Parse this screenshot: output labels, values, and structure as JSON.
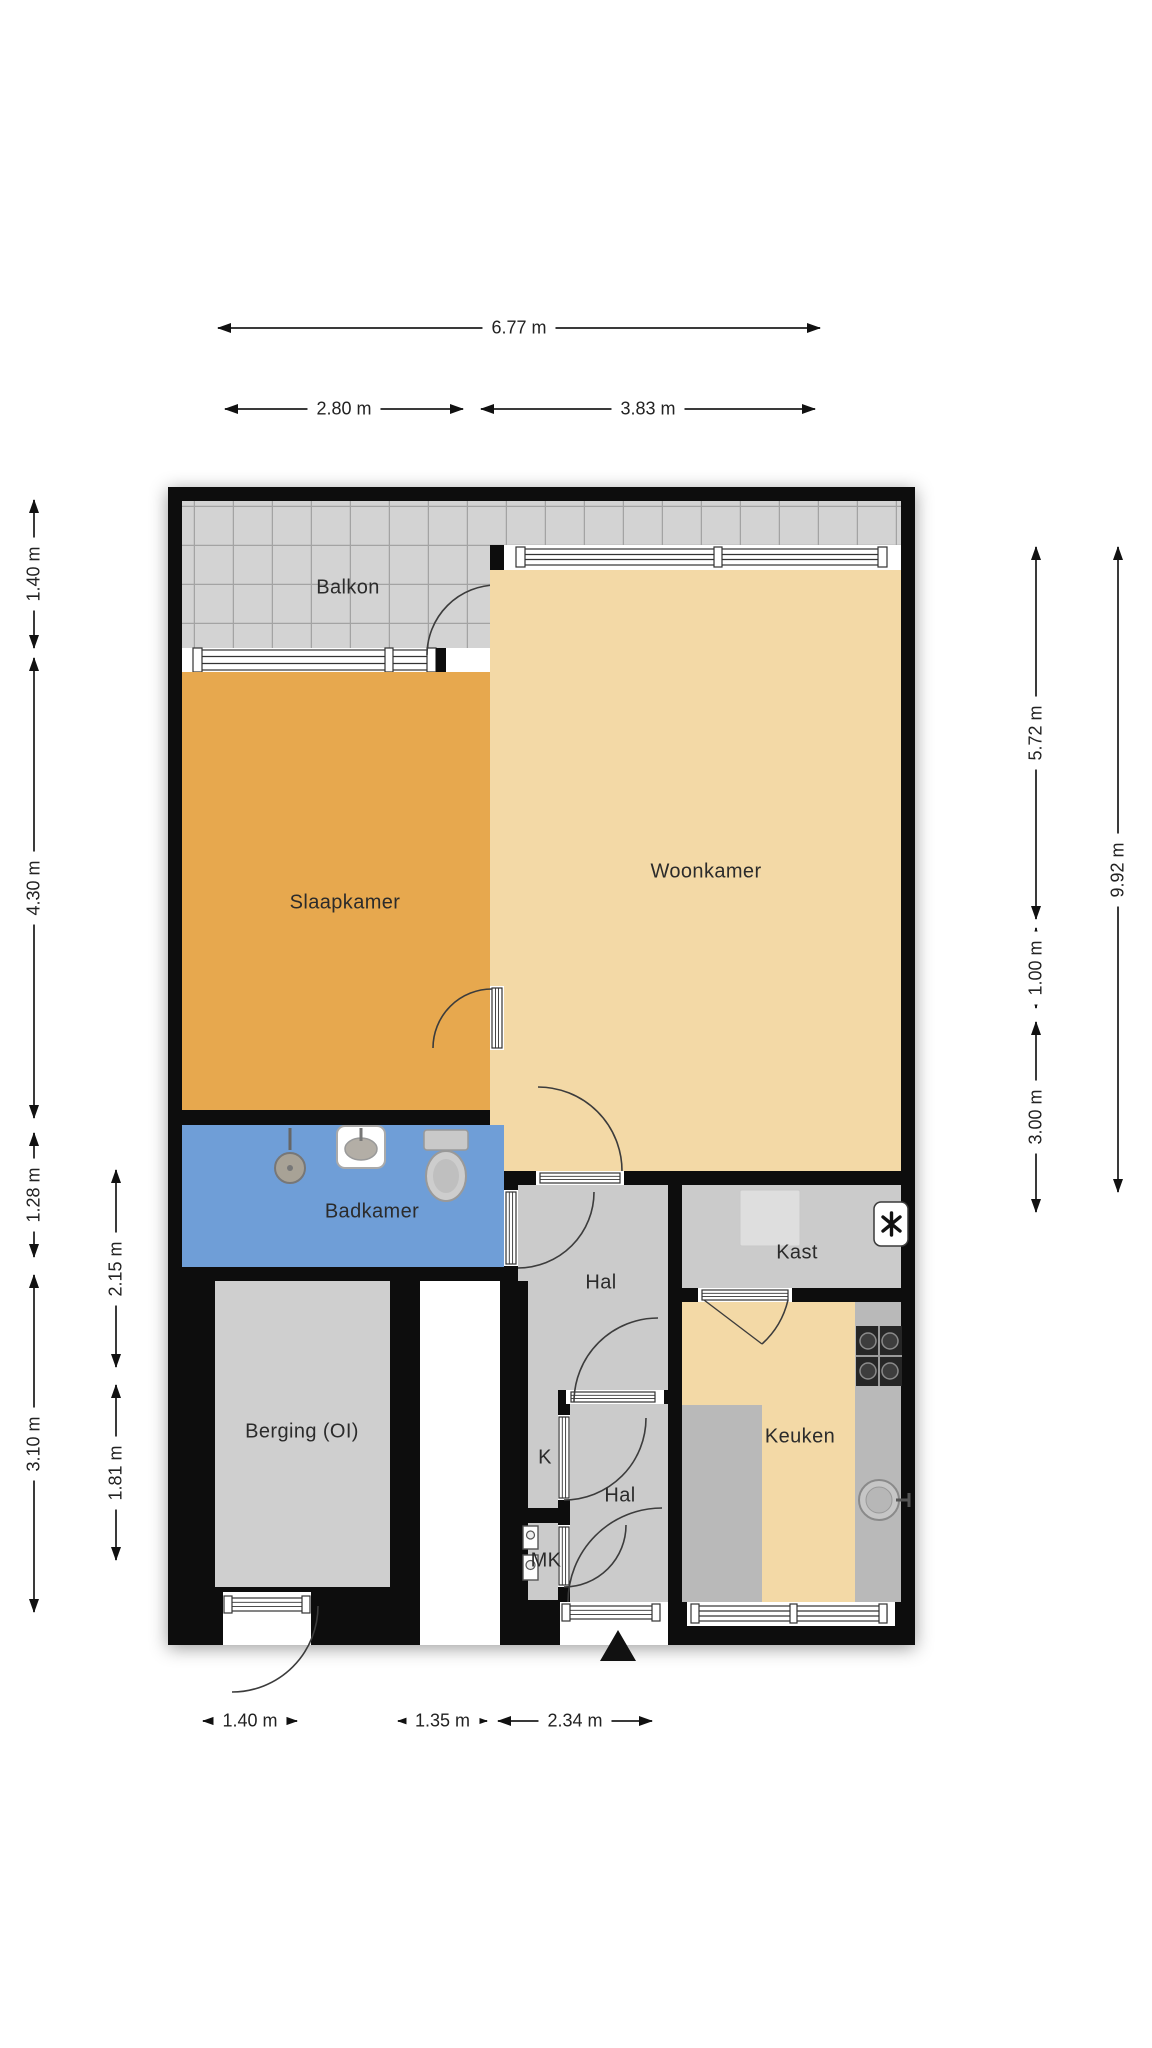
{
  "room_labels": {
    "balkon": "Balkon",
    "slaapkamer": "Slaapkamer",
    "woonkamer": "Woonkamer",
    "badkamer": "Badkamer",
    "hal_upper": "Hal",
    "kast": "Kast",
    "berging": "Berging (OI)",
    "keuken": "Keuken",
    "closet_k": "K",
    "hal_lower": "Hal",
    "meter_cupboard": "MK"
  },
  "dimensions": {
    "top_total": "6.77 m",
    "top_left": "2.80 m",
    "top_right": "3.83 m",
    "left_outer": [
      "1.40 m",
      "4.30 m",
      "1.28 m",
      "3.10 m"
    ],
    "left_inner": [
      "2.15 m",
      "1.81 m"
    ],
    "right_inner": [
      "5.72 m",
      "1.00 m",
      "3.00 m"
    ],
    "right_outer": [
      "9.92 m"
    ],
    "bottom": [
      "1.40 m",
      "1.35 m",
      "2.34 m"
    ]
  },
  "colors": {
    "wall": "#0d0d0d",
    "balcony_tile": "#d3d3d3",
    "tile_line": "#a3a3a3",
    "bedroom": "#e7a84e",
    "living": "#f3d9a6",
    "bathroom": "#6f9ed7",
    "hall": "#cbcbcb",
    "storage": "#cfcfcf",
    "counter": "#b9b9b9",
    "appliance_dark": "#262626",
    "dim_line": "#333333",
    "text": "#1f1f1f"
  },
  "icons": {
    "entrance_arrow": "▲",
    "ventilation_unit": "fan/snowflake glyph",
    "stove": "4-burner hob",
    "kitchen_sink": "round sink with tap",
    "toilet": "toilet with cistern",
    "washbasin": "basin with tap",
    "shower": "shower head",
    "boiler": "boiler block",
    "meter_boxes": "two meters"
  }
}
